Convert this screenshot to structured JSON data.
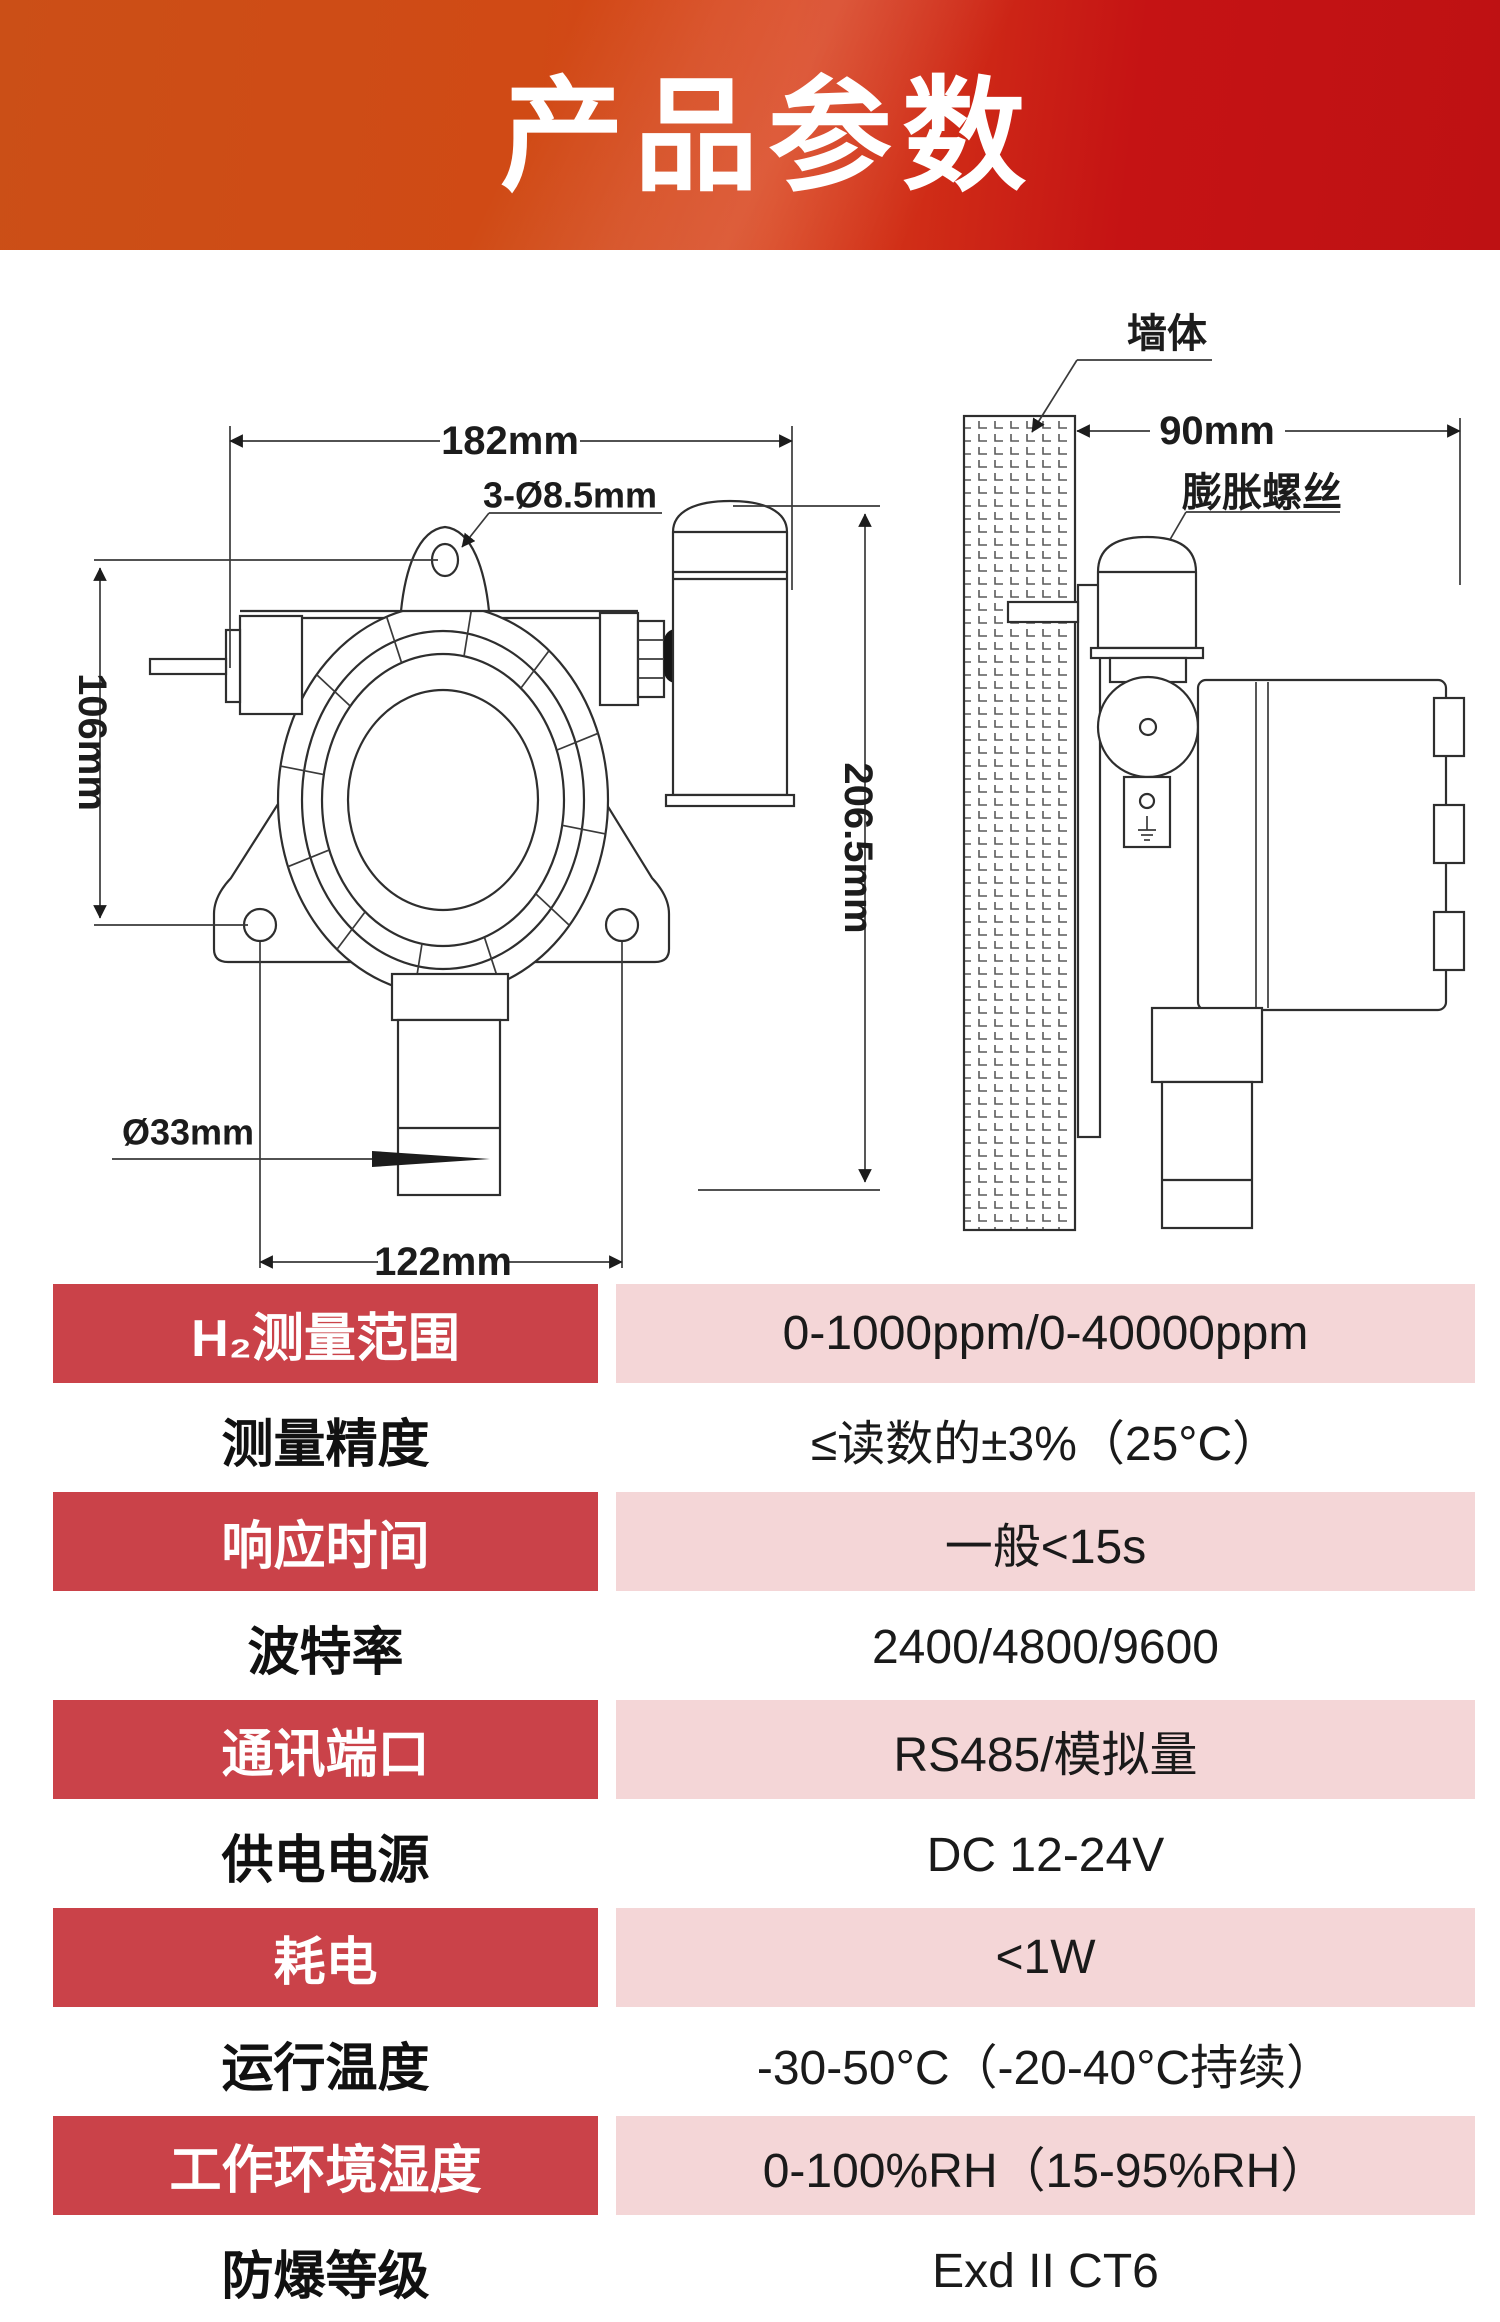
{
  "header": {
    "title": "产品参数"
  },
  "diagram": {
    "front": {
      "width_dim": "182mm",
      "hole_dim": "3-Ø8.5mm",
      "left_height_dim": "106mm",
      "overall_height_dim": "206.5mm",
      "probe_dia_dim": "Ø33mm",
      "mount_span_dim": "122mm"
    },
    "side": {
      "depth_dim": "90mm",
      "wall_label": "墙体",
      "anchor_label": "膨胀螺丝"
    }
  },
  "spec_table": {
    "rows": [
      {
        "label": "H₂测量范围",
        "value": "0-1000ppm/0-40000ppm"
      },
      {
        "label": "测量精度",
        "value": "≤读数的±3%（25°C）"
      },
      {
        "label": "响应时间",
        "value": "一般<15s"
      },
      {
        "label": "波特率",
        "value": "2400/4800/9600"
      },
      {
        "label": "通讯端口",
        "value": "RS485/模拟量"
      },
      {
        "label": "供电电源",
        "value": "DC 12-24V"
      },
      {
        "label": "耗电",
        "value": "<1W"
      },
      {
        "label": "运行温度",
        "value": "-30-50°C（-20-40°C持续）"
      },
      {
        "label": "工作环境湿度",
        "value": "0-100%RH（15-95%RH）"
      },
      {
        "label": "防爆等级",
        "value": "Exd II CT6"
      }
    ]
  },
  "colors": {
    "accent_red": "#CA4249",
    "accent_pink": "#F4D6D7",
    "header_orange": "#CB4F17",
    "header_red": "#BE1113"
  }
}
